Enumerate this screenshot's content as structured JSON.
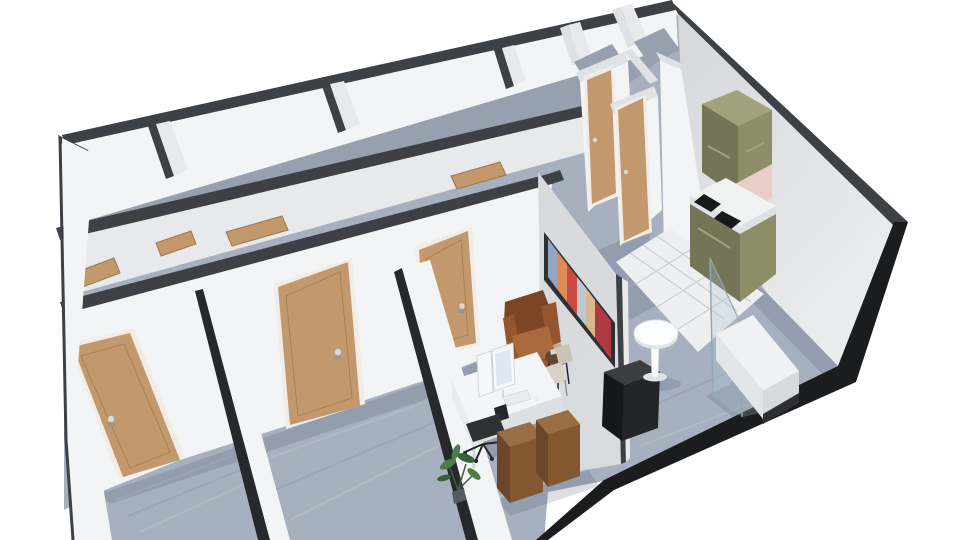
{
  "scene": {
    "title": "3D isometric floor plan render of an office suite",
    "description": "Perspective 3D rendering of a long office floor plan: a row of back rooms with open door tops, three front rooms with tan doors, a furnished private office with desk, monitors, leather armchair and wall art, a hallway with two doors, two small storage rooms, a kitchenette with olive cabinets and cooktop on white tile, and a reception area with a round pedestal table, black counter and glass display bench.",
    "render_style": "floorplanner-3d",
    "background": "#ffffff"
  },
  "rooms": [
    {
      "id": "back-room-row",
      "label": "Row of back rooms along rear wall",
      "count": 4
    },
    {
      "id": "room-1",
      "label": "Front room 1 (closed tan door)"
    },
    {
      "id": "room-2",
      "label": "Front room 2 (closed tan door)"
    },
    {
      "id": "private-office",
      "label": "Private office with desk and armchair"
    },
    {
      "id": "hallway",
      "label": "Hallway with two tan doors"
    },
    {
      "id": "storage-room-a",
      "label": "Small storage room A (top-right)"
    },
    {
      "id": "storage-room-b",
      "label": "Small storage room B (top-right)"
    },
    {
      "id": "kitchenette",
      "label": "Kitchenette with olive cabinets on white tile"
    },
    {
      "id": "reception",
      "label": "Reception / lounge area"
    }
  ],
  "doors": {
    "closed_count": 5,
    "open_top_panels_count": 4,
    "color": "#c3986c",
    "frame_color": "#f1ede6"
  },
  "furniture": [
    {
      "id": "office-desk",
      "label": "White desk with two monitors, keyboard and mouse"
    },
    {
      "id": "office-chair",
      "label": "Black swivel office chair"
    },
    {
      "id": "guest-chair",
      "label": "Light guest chair"
    },
    {
      "id": "leather-armchair",
      "label": "Brown leather wingback armchair"
    },
    {
      "id": "side-table",
      "label": "Small round side table with books"
    },
    {
      "id": "storage-cubes",
      "label": "Two walnut storage cubes",
      "count": 2
    },
    {
      "id": "potted-plant",
      "label": "Green potted plant"
    },
    {
      "id": "wall-art",
      "label": "Panoramic abstract artwork on partition"
    },
    {
      "id": "partition-wall",
      "label": "Gray partition wall between office and reception"
    },
    {
      "id": "reception-counter",
      "label": "Black reception counter"
    },
    {
      "id": "tulip-table",
      "label": "White round pedestal table"
    },
    {
      "id": "display-bench",
      "label": "White display bench with glass screen"
    },
    {
      "id": "kitchen-upper-cabinet",
      "label": "Olive wall cabinet"
    },
    {
      "id": "kitchen-base-cabinet",
      "label": "Olive base cabinets with white counter and two black cooktops"
    }
  ],
  "palette": {
    "bg": "#ffffff",
    "wallCap": "#3d4145",
    "wallCapDark": "#26292c",
    "wallFace": "#f3f4f5",
    "wallFaceShade": "#e7e9ea",
    "wallFaceDark": "#d9dbde",
    "capLight": "#dfe2e4",
    "partitionFace": "#d8dadd",
    "floor": "#a7b0bf",
    "floorDark": "#96a0af",
    "floorStreak": "#b6bfcb",
    "tile": "#edeff0",
    "grout": "#c7cbcf",
    "shadow": "rgba(62,72,94,0.18)",
    "slabEdge": "#1a1c1e",
    "door": "#c3986c",
    "doorEdge": "#9d7848",
    "doorFrame": "#f1ede6",
    "handle": "#d7dadd",
    "handleDark": "#8e949a",
    "olive": "#8d8d69",
    "oliveLight": "#a2a27d",
    "oliveDark": "#747456",
    "counterWhite": "#f1f2f2",
    "counterEdge": "#dfe2e4",
    "cooktop": "#17191b",
    "backsplash": "#e9cdc7",
    "desk": "#f3f5f6",
    "deskSide": "#dde0e3",
    "deskLeft": "#e9eced",
    "screen": "#dce8f3",
    "monitorBody": "#f6f8fa",
    "monitorEdge": "#d2d6da",
    "keyboard": "#e9ecee",
    "chairDark": "#2f3235",
    "chairDarker": "#242629",
    "chairLight": "#d7d3c9",
    "chairLightShade": "#c9c4b8",
    "armDark": "#7c4526",
    "armMid": "#95562f",
    "armLight": "#aa6a3d",
    "wood": "#83572f",
    "woodTop": "#9a6e45",
    "woodDark": "#6d452a",
    "plant": "#4d7c4a",
    "plantDark": "#3a6138",
    "pot": "#565c60",
    "tulip": "#fbfcfd",
    "tulipShade": "#dfe3e6",
    "counterBlack": "#232528",
    "counterBlackTop": "#3b3d40",
    "counterBlackSide": "#161719",
    "bench": "#f0f1f2",
    "benchLeft": "#e3e6e8",
    "benchFront": "#d7dadd",
    "benchPlinth": "#2e3033",
    "glass": "rgba(173,195,208,0.28)",
    "glassEdge": "#93a7b2",
    "sideTable": "#5f4733",
    "bookLight": "#d9d5c9",
    "bookDark": "#b4ab9c",
    "artFrame": "#2e3134",
    "art1": "#93a7c4",
    "art2": "#e08b57",
    "art3": "#c84a40",
    "art4": "#b9c7d6",
    "art5": "#d8b88c",
    "art6": "#b03a42",
    "rightWallLight": "#ebedee",
    "rightWallMid": "#d5d7da"
  }
}
